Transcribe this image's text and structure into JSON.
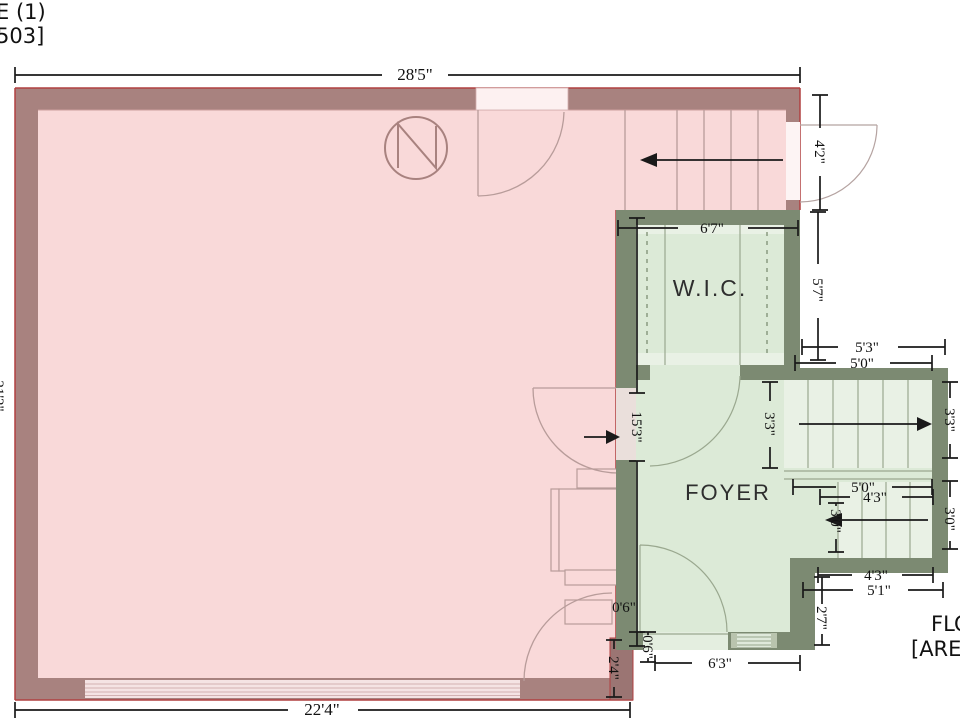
{
  "page": {
    "top_left_line1": "E (1)",
    "top_left_line2": "503]",
    "bottom_right_line1": "FLO",
    "bottom_right_line2": "[ARE"
  },
  "rooms": {
    "wic": "W.I.C.",
    "foyer": "FOYER"
  },
  "dimensions": {
    "top": "28'5\"",
    "bottom": "22'4\"",
    "left_partial": "21'2\"",
    "stair_door": "4'2\"",
    "wic_width": "6'7\"",
    "wic_height": "5'7\"",
    "upper_53": "5'3\"",
    "upper_50": "5'0\"",
    "stair_upper_left": "3'3\"",
    "stair_upper_right": "3'3\"",
    "mid_50": "5'0\"",
    "mid_43": "4'3\"",
    "stair_lower_width": "3'0\"",
    "stair_lower_right": "3'0\"",
    "low_43": "4'3\"",
    "low_51": "5'1\"",
    "low_27": "2'7\"",
    "foyer_height": "15'3\"",
    "offset_h": "0'6\"",
    "offset_v": "0'6\"",
    "corner": "2'4\"",
    "foyer_width": "6'3\""
  },
  "colors": {
    "pink_floor": "#f9d9d9",
    "pink_wall": "#a8827f",
    "pink_outline": "#b04040",
    "green_floor": "#dcead7",
    "green_wall": "#7c8a72",
    "stair_floor": "#e9f1e5",
    "dim_line": "#1a1a1a"
  }
}
